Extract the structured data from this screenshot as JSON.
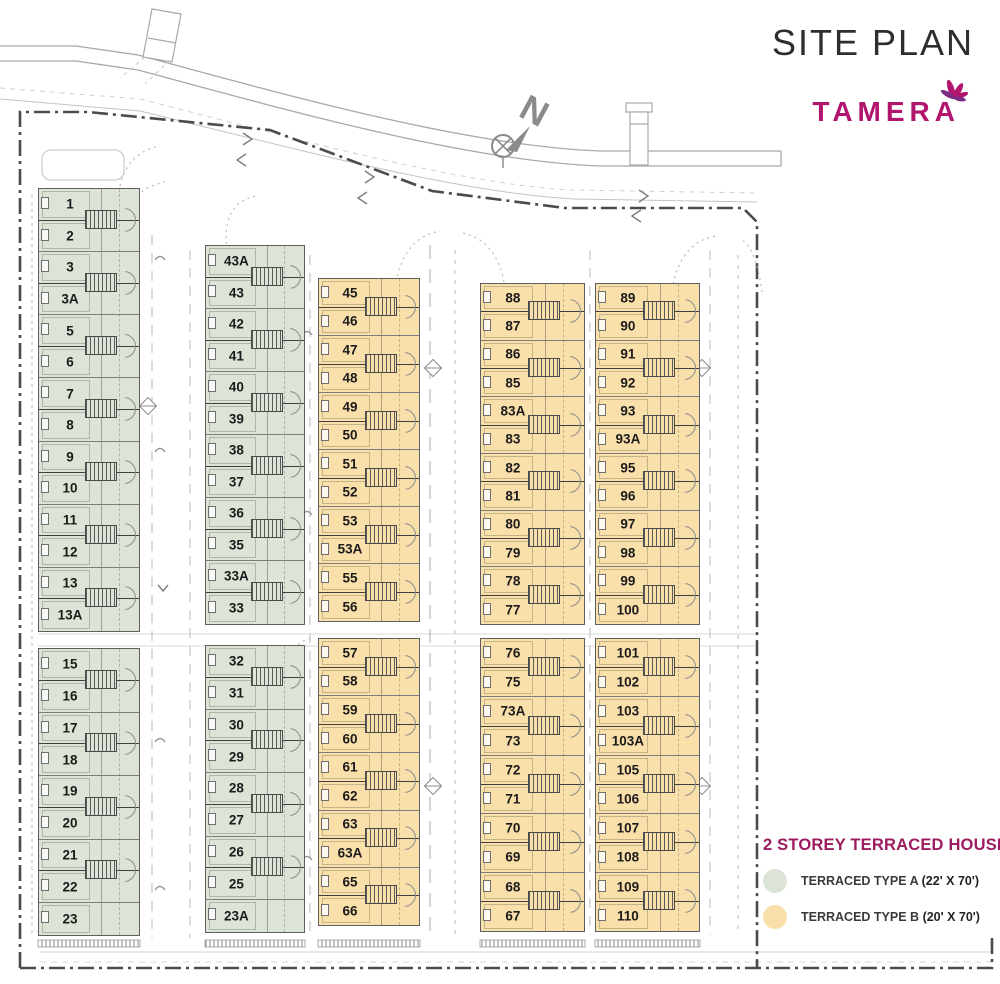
{
  "header": {
    "title": "SITE PLAN",
    "brand": "TAMERA"
  },
  "north_label": "N",
  "legend": {
    "title": "2 STOREY TERRACED HOUSE",
    "items": [
      {
        "label": "TERRACED TYPE A",
        "dimension": "(22' X 70')",
        "color": "#dce4d7"
      },
      {
        "label": "TERRACED TYPE B",
        "dimension": "(20' X 70')",
        "color": "#f9dfaa"
      }
    ]
  },
  "colors": {
    "type_a": "#dce4d7",
    "type_b": "#f9dfaa",
    "brand": "#b2156e",
    "legend_title": "#9c1c5f",
    "boundary": "#4b4b4b",
    "road": "#a9a9a9",
    "lot_number": "#1b1b1b"
  },
  "columns": [
    {
      "type": "A",
      "x": 38,
      "width": 102,
      "blocks": [
        {
          "y": 188,
          "height": 444,
          "lots": [
            "1",
            "2",
            "3",
            "3A",
            "5",
            "6",
            "7",
            "8",
            "9",
            "10",
            "11",
            "12",
            "13",
            "13A"
          ]
        },
        {
          "y": 648,
          "height": 288,
          "lots": [
            "15",
            "16",
            "17",
            "18",
            "19",
            "20",
            "21",
            "22",
            "23"
          ]
        }
      ]
    },
    {
      "type": "A",
      "x": 205,
      "width": 100,
      "blocks": [
        {
          "y": 245,
          "height": 380,
          "lots": [
            "43A",
            "43",
            "42",
            "41",
            "40",
            "39",
            "38",
            "37",
            "36",
            "35",
            "33A",
            "33"
          ]
        },
        {
          "y": 645,
          "height": 288,
          "lots": [
            "32",
            "31",
            "30",
            "29",
            "28",
            "27",
            "26",
            "25",
            "23A"
          ]
        }
      ]
    },
    {
      "type": "B",
      "x": 318,
      "width": 102,
      "blocks": [
        {
          "y": 278,
          "height": 344,
          "lots": [
            "45",
            "46",
            "47",
            "48",
            "49",
            "50",
            "51",
            "52",
            "53",
            "53A",
            "55",
            "56"
          ]
        },
        {
          "y": 638,
          "height": 288,
          "lots": [
            "57",
            "58",
            "59",
            "60",
            "61",
            "62",
            "63",
            "63A",
            "65",
            "66"
          ]
        }
      ]
    },
    {
      "type": "B",
      "x": 480,
      "width": 105,
      "blocks": [
        {
          "y": 283,
          "height": 342,
          "lots": [
            "88",
            "87",
            "86",
            "85",
            "83A",
            "83",
            "82",
            "81",
            "80",
            "79",
            "78",
            "77"
          ]
        },
        {
          "y": 638,
          "height": 294,
          "lots": [
            "76",
            "75",
            "73A",
            "73",
            "72",
            "71",
            "70",
            "69",
            "68",
            "67"
          ]
        }
      ]
    },
    {
      "type": "B",
      "x": 595,
      "width": 105,
      "blocks": [
        {
          "y": 283,
          "height": 342,
          "lots": [
            "89",
            "90",
            "91",
            "92",
            "93",
            "93A",
            "95",
            "96",
            "97",
            "98",
            "99",
            "100"
          ]
        },
        {
          "y": 638,
          "height": 294,
          "lots": [
            "101",
            "102",
            "103",
            "103A",
            "105",
            "106",
            "107",
            "108",
            "109",
            "110"
          ]
        }
      ]
    }
  ]
}
